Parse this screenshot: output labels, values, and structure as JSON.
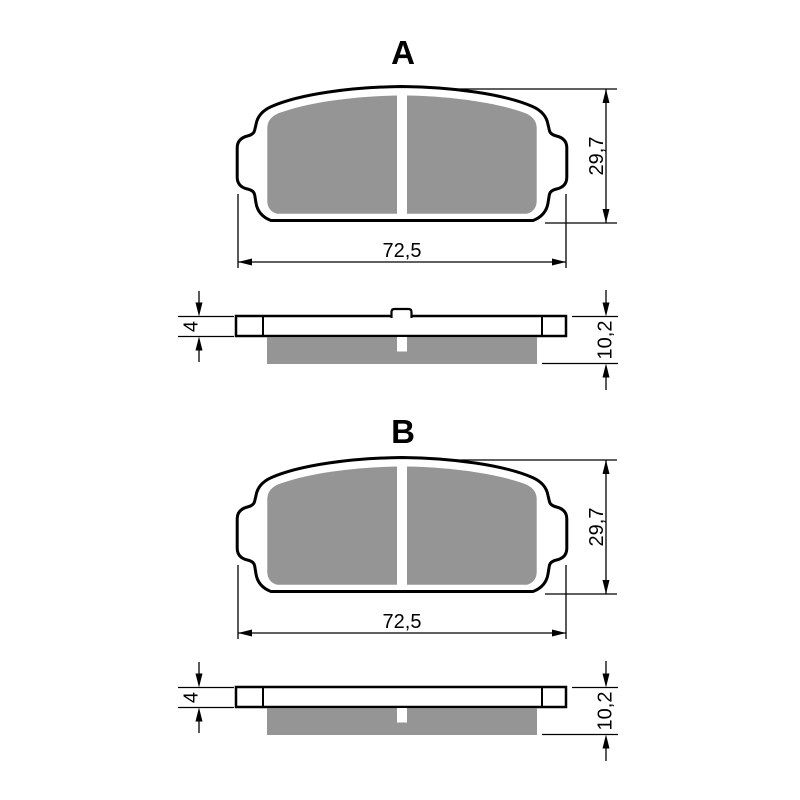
{
  "colors": {
    "line": "#000000",
    "friction": "#959595",
    "background": "#ffffff",
    "plate_fill": "#ffffff"
  },
  "sections": [
    {
      "label": "A",
      "front_view": {
        "width_dim": "72,5",
        "height_dim": "29,7"
      },
      "side_view": {
        "backplate_thickness_dim": "4",
        "total_thickness_dim": "10,2",
        "has_center_nub": true
      }
    },
    {
      "label": "B",
      "front_view": {
        "width_dim": "72,5",
        "height_dim": "29,7"
      },
      "side_view": {
        "backplate_thickness_dim": "4",
        "total_thickness_dim": "10,2",
        "has_center_nub": false
      }
    }
  ]
}
